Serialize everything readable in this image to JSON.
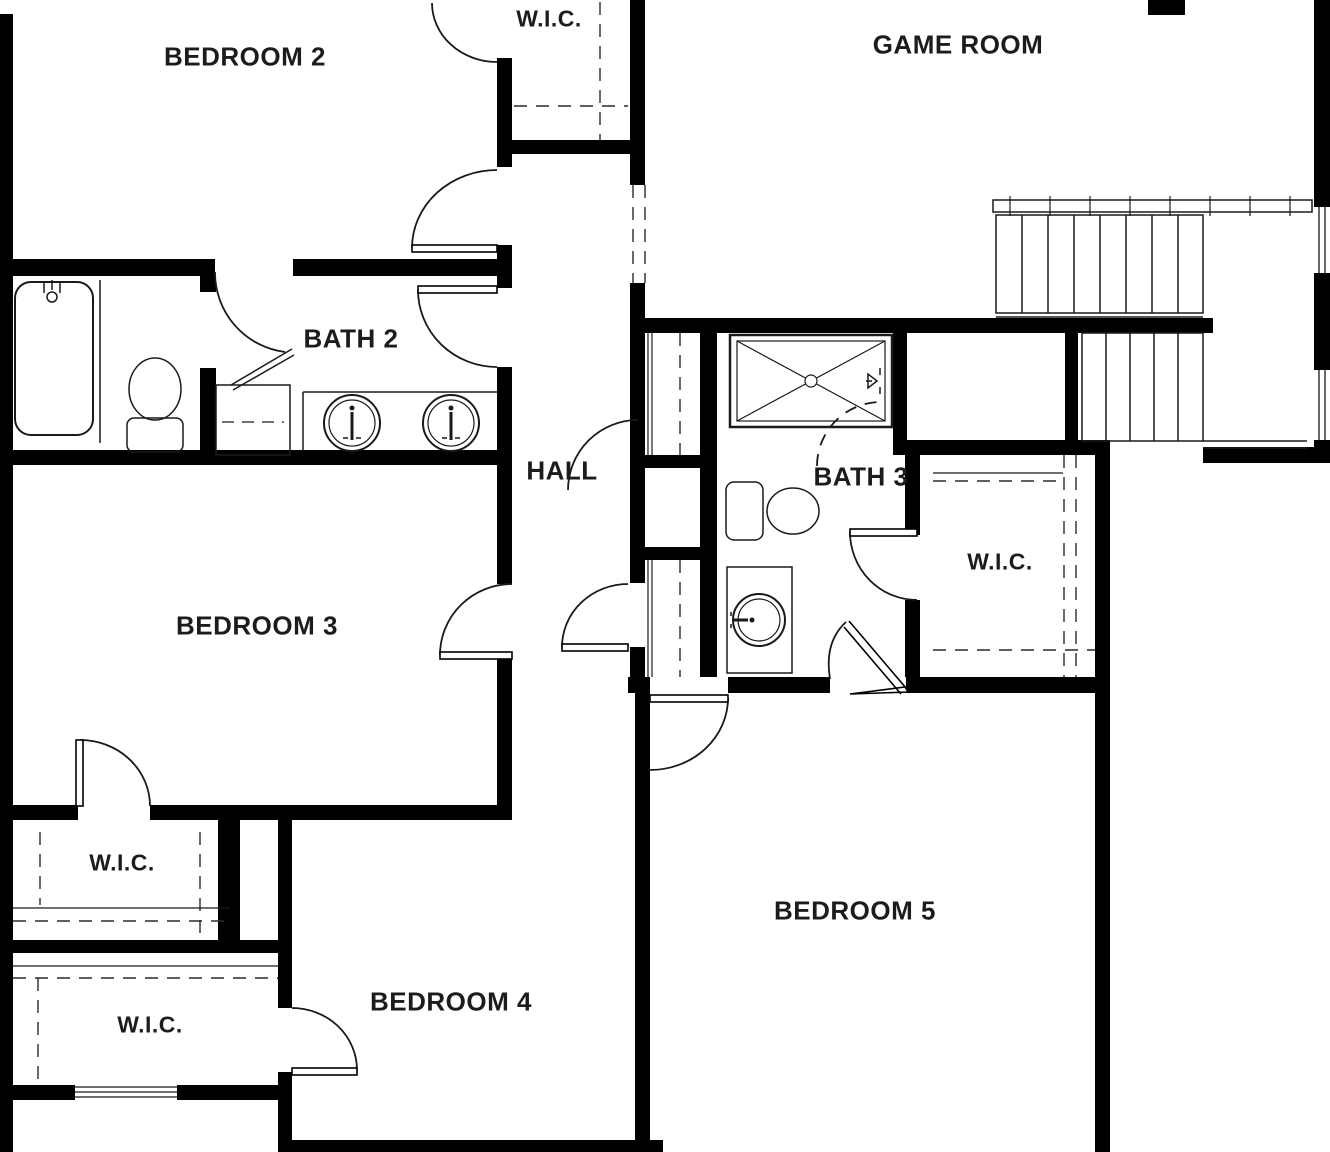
{
  "plan_title": "Second floor plan",
  "colors": {
    "wall": "#000000",
    "line": "#1a1a1a",
    "background": "#ffffff",
    "label": "#1c1c1c"
  },
  "rooms": [
    {
      "id": "bedroom-2",
      "label": "BEDROOM 2"
    },
    {
      "id": "wic-top",
      "label": "W.I.C."
    },
    {
      "id": "game-room",
      "label": "GAME ROOM"
    },
    {
      "id": "bath-2",
      "label": "BATH 2"
    },
    {
      "id": "hall",
      "label": "HALL"
    },
    {
      "id": "bath-3",
      "label": "BATH 3"
    },
    {
      "id": "wic-right",
      "label": "W.I.C."
    },
    {
      "id": "bedroom-3",
      "label": "BEDROOM 3"
    },
    {
      "id": "wic-left",
      "label": "W.I.C."
    },
    {
      "id": "wic-lower-left",
      "label": "W.I.C."
    },
    {
      "id": "bedroom-4",
      "label": "BEDROOM 4"
    },
    {
      "id": "bedroom-5",
      "label": "BEDROOM 5"
    }
  ],
  "fixtures": [
    "bathtub-icon",
    "toilet-icon",
    "double-vanity-sink-icon",
    "linen-closet-icon",
    "shower-icon",
    "toilet-icon",
    "vanity-sink-icon",
    "staircase-icon",
    "closet-shelving-icon",
    "window-icon",
    "door-swing-icon"
  ]
}
